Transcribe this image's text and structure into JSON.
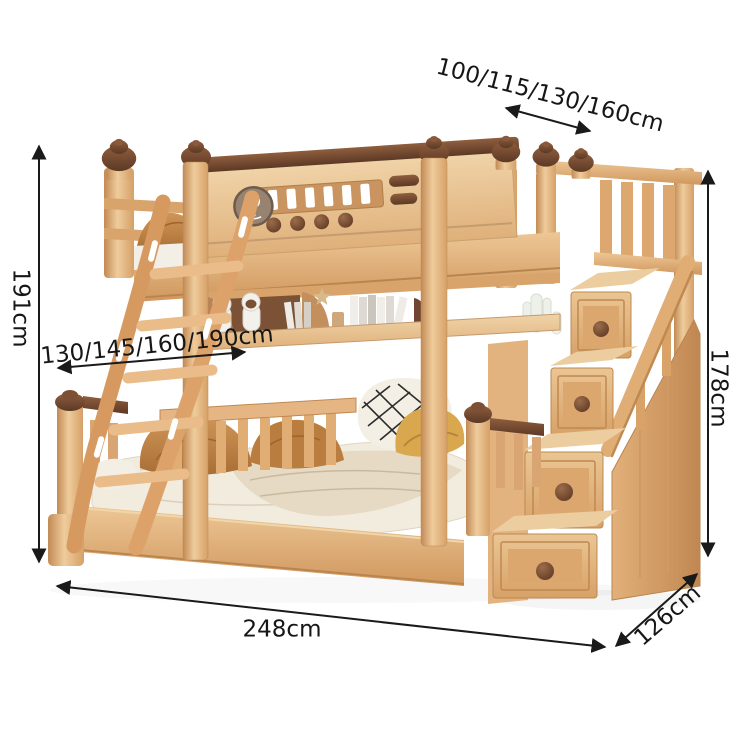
{
  "dimension_labels": {
    "top_width": "100/115/130/160cm",
    "left_height": "191cm",
    "inner_bed_length": "130/145/160/190cm",
    "right_height": "178cm",
    "bottom_length": "248cm",
    "bottom_depth": "126cm"
  },
  "colors": {
    "background": "#ffffff",
    "annotation": "#1a1a1a",
    "wood_light": "#f0d3a8",
    "wood_mid": "#dda76f",
    "wood_deep": "#c08850",
    "trim_dark_brown": "#6e4631",
    "bedding_white": "#f2ecdf",
    "blanket_beige": "#e6dac5",
    "pillow_caramel": "#c68c49",
    "pillow_mustard": "#d9a84e",
    "medallion": "#97836f"
  }
}
